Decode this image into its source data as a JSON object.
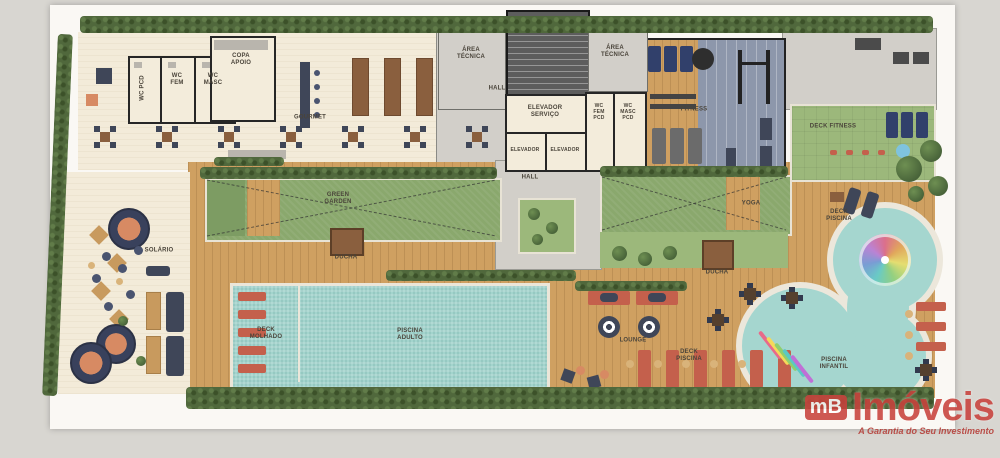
{
  "title": "Planta humanizada - área de lazer (rooftop)",
  "watermark": {
    "logo_prefix": "mB",
    "logo_name": "Imóveis",
    "tagline": "A Garantia do Seu Investimento"
  },
  "colors": {
    "watermark_red": "#c9423c",
    "pool_teal": "#a3d4cd",
    "deck_wood": "#cfa061",
    "turf_green": "#9cb87b",
    "pergola_green": "#8aa86d",
    "hedge_green": "#50683c",
    "fitness_floor": "#8d97ab",
    "lounger_red": "#c4604c",
    "furniture_navy": "#3f4658"
  },
  "labels": {
    "copa_apoio": "COPA APOIO",
    "wc_pcd": "WC PCD",
    "wc_fem": "WC FEM",
    "wc_masc": "WC MASC",
    "gourmet": "GOURMET",
    "area_tecnica_left": "ÁREA TÉCNICA",
    "area_tecnica_right": "ÁREA TÉCNICA",
    "hall_upper": "HALL",
    "hall_lower": "HALL",
    "elevador_servico": "ELEVADOR SERVIÇO",
    "elevador_1": "ELEVADOR",
    "elevador_2": "ELEVADOR",
    "wc_fem_pcd": "WC FEM PCD",
    "wc_masc_pcd": "WC MASC PCD",
    "fitness": "FITNESS",
    "deck_fitness": "DECK FITNESS",
    "green_garden": "GREEN GARDEN",
    "yoga": "YOGA",
    "solario": "SOLÁRIO",
    "ducha_left": "DUCHA",
    "ducha_right": "DUCHA",
    "deck_molhado": "DECK MOLHADO",
    "piscina_adulto": "PISCINA ADULTO",
    "lounge": "LOUNGE",
    "deck_piscina_center": "DECK PISCINA",
    "deck_piscina_right": "DECK PISCINA",
    "piscina_infantil": "PISCINA INFANTIL"
  }
}
